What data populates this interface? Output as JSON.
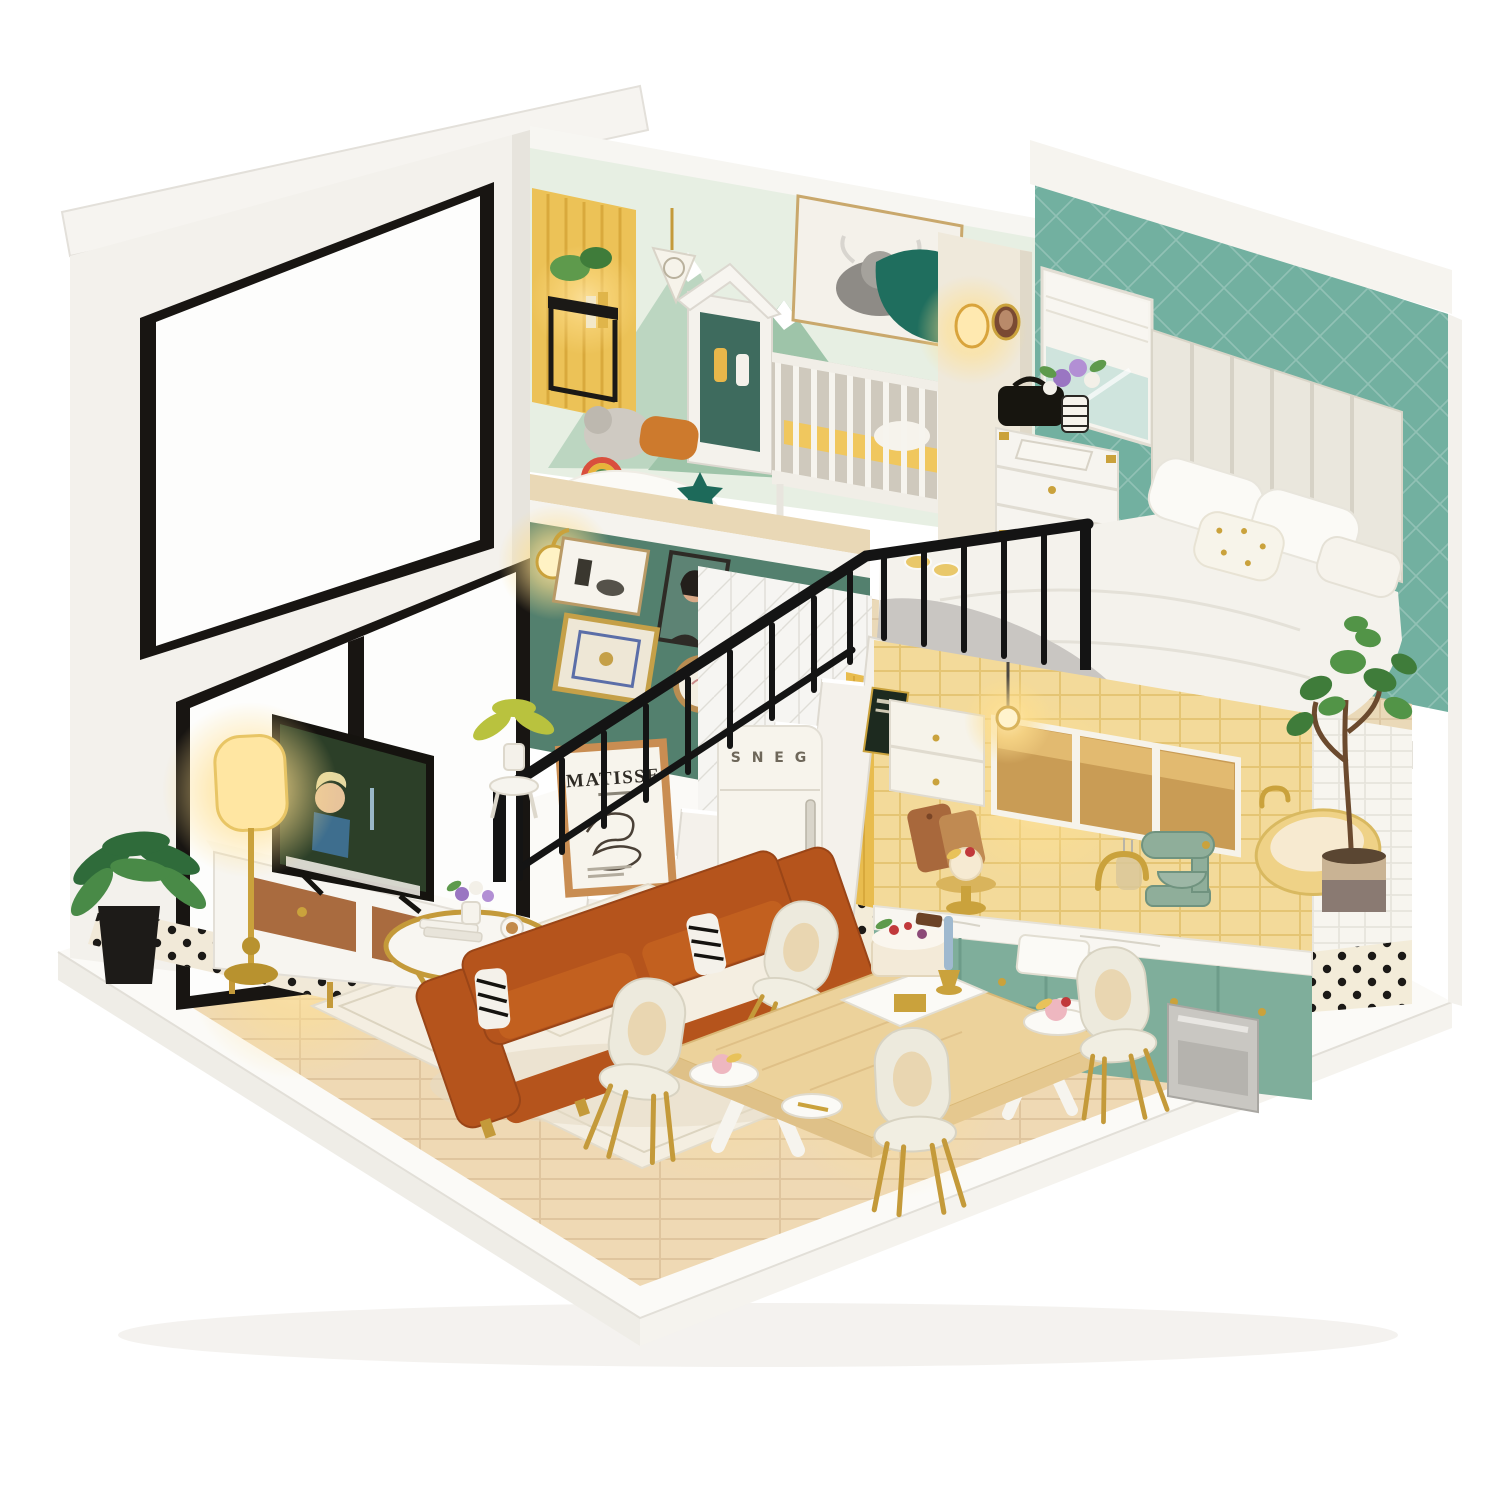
{
  "scene": {
    "subject": "miniature-dollhouse-loft-diorama",
    "texts": {
      "poster_title": "MATISSE",
      "fridge_brand": "S N E G"
    },
    "palette": {
      "background": "#ffffff",
      "exterior_white": "#f3f1ec",
      "bedroom_teal": "#72b0a0",
      "gallery_teal": "#53806e",
      "nursery_mint": "#e7efe3",
      "mural_green": "#9ec4a9",
      "tile_yellow": "#f3da9a",
      "curtain_yellow": "#ecc257",
      "cabinet_sage": "#7fae9b",
      "sofa_cognac": "#b5541c",
      "tub_yellow": "#efd287",
      "wood_floor": "#efd9b4",
      "wood_table": "#ecd29b",
      "gold": "#c49a3a",
      "railing_black": "#141414",
      "glow_warm": "#ffdf8e",
      "blanket_gray": "#c9c6c2",
      "plant_green": "#4c8a3f"
    },
    "objects": [
      "roof-slab",
      "glass-wall-windows",
      "nursery",
      "crib",
      "wardrobe",
      "highland-cow-art",
      "plant-stand",
      "gallery-wall",
      "staircase",
      "black-railing",
      "matisse-poster",
      "retro-fridge",
      "kitchen",
      "stand-mixer",
      "loft-bedroom",
      "bed",
      "headboard",
      "campaign-dresser",
      "wall-sconce",
      "bathtub",
      "fiddle-leaf-fig",
      "living-room",
      "tv",
      "tv-console",
      "floor-lamp",
      "coffee-table",
      "leather-sofa",
      "area-rug",
      "dining-table",
      "dining-chairs",
      "celebration-cake",
      "potted-plants",
      "polka-dot-floor"
    ]
  }
}
